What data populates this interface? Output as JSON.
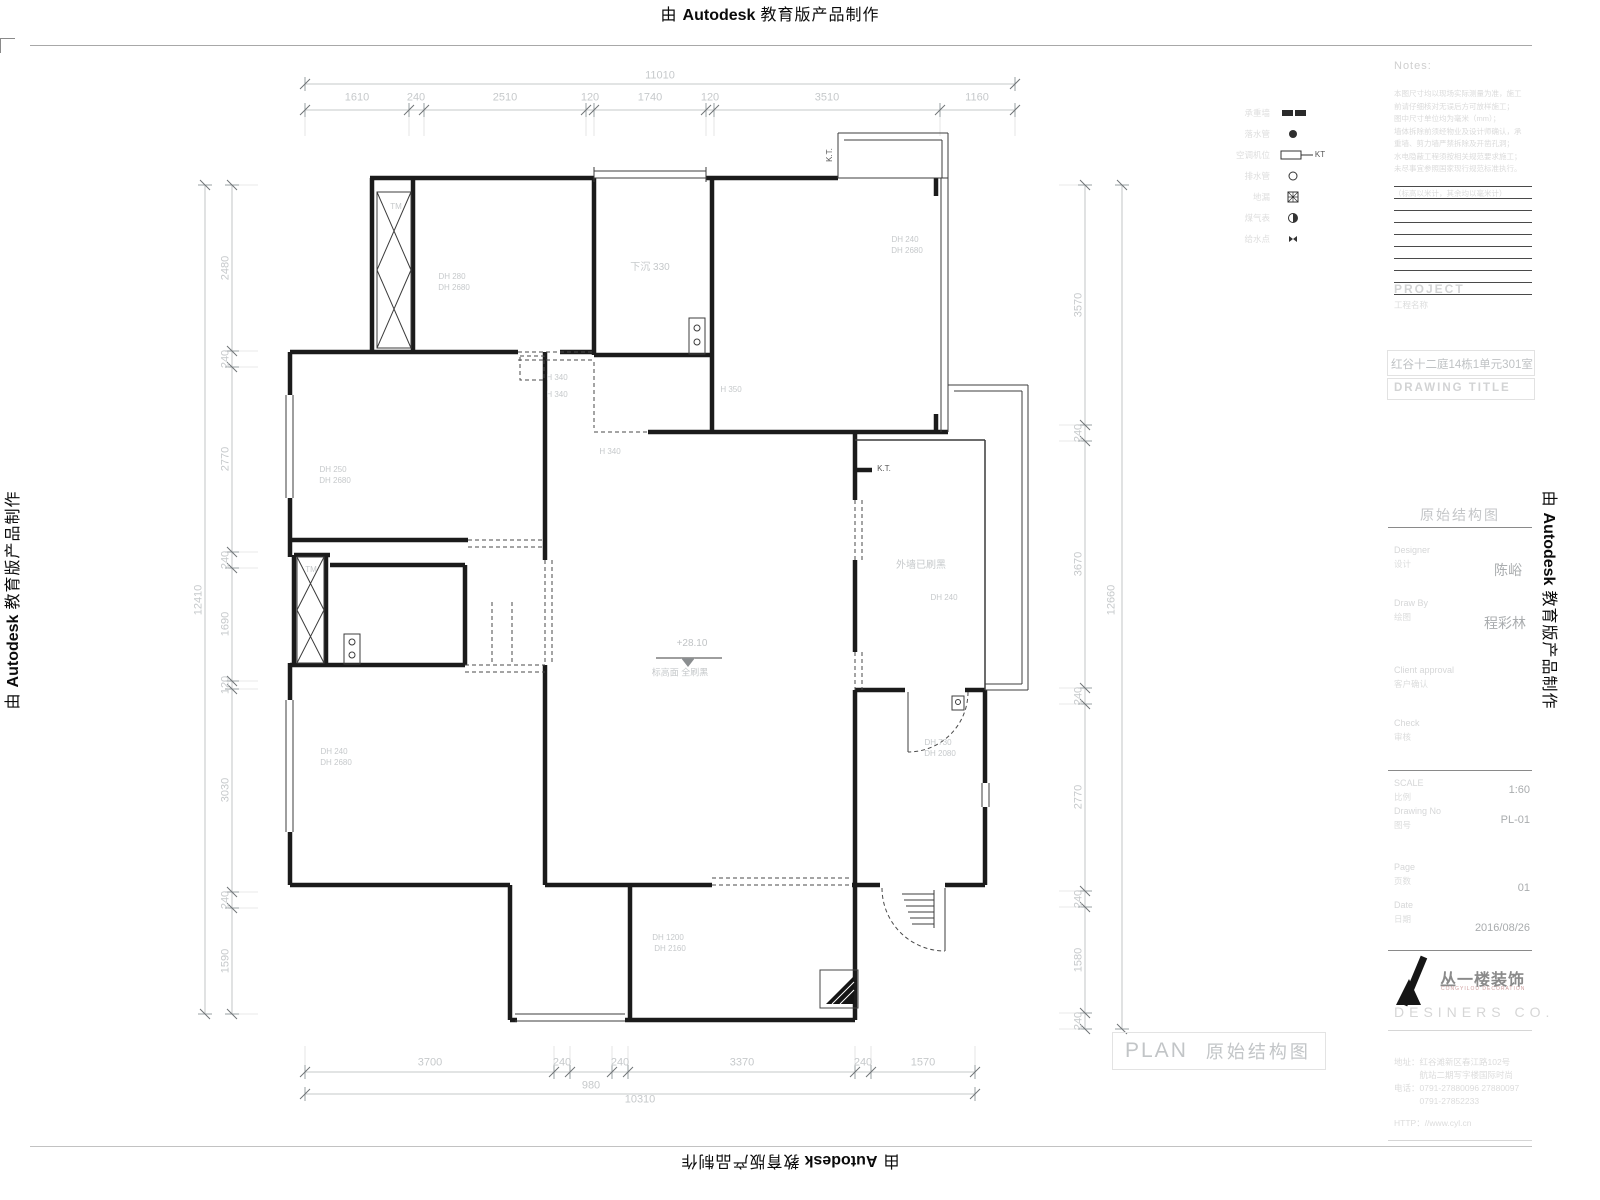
{
  "watermark": {
    "prefix": "由",
    "brand": "Autodesk",
    "suffix": "教育版产品制作"
  },
  "dimensions": {
    "top": [
      {
        "t": "11010",
        "x": 660,
        "y": 76
      },
      {
        "t": "1610",
        "x": 357,
        "y": 98
      },
      {
        "t": "240",
        "x": 416,
        "y": 98
      },
      {
        "t": "2510",
        "x": 505,
        "y": 98
      },
      {
        "t": "120",
        "x": 590,
        "y": 98
      },
      {
        "t": "1740",
        "x": 650,
        "y": 98
      },
      {
        "t": "120",
        "x": 710,
        "y": 98
      },
      {
        "t": "3510",
        "x": 827,
        "y": 98
      },
      {
        "t": "1160",
        "x": 977,
        "y": 98
      }
    ],
    "left": [
      {
        "t": "12410",
        "x": 199,
        "y": 600,
        "r": -90
      },
      {
        "t": "2480",
        "x": 226,
        "y": 268,
        "r": -90
      },
      {
        "t": "240",
        "x": 226,
        "y": 359,
        "r": -90
      },
      {
        "t": "2770",
        "x": 226,
        "y": 459,
        "r": -90
      },
      {
        "t": "240",
        "x": 226,
        "y": 560,
        "r": -90
      },
      {
        "t": "1690",
        "x": 226,
        "y": 624,
        "r": -90
      },
      {
        "t": "120",
        "x": 226,
        "y": 685,
        "r": -90
      },
      {
        "t": "3030",
        "x": 226,
        "y": 790,
        "r": -90
      },
      {
        "t": "240",
        "x": 226,
        "y": 900,
        "r": -90
      },
      {
        "t": "1590",
        "x": 226,
        "y": 961,
        "r": -90
      }
    ],
    "right": [
      {
        "t": "3570",
        "x": 1079,
        "y": 305,
        "r": -90
      },
      {
        "t": "240",
        "x": 1079,
        "y": 433,
        "r": -90
      },
      {
        "t": "3670",
        "x": 1079,
        "y": 564,
        "r": -90
      },
      {
        "t": "12660",
        "x": 1112,
        "y": 600,
        "r": -90
      },
      {
        "t": "240",
        "x": 1079,
        "y": 696,
        "r": -90
      },
      {
        "t": "2770",
        "x": 1079,
        "y": 797,
        "r": -90
      },
      {
        "t": "240",
        "x": 1079,
        "y": 899,
        "r": -90
      },
      {
        "t": "1580",
        "x": 1079,
        "y": 960,
        "r": -90
      },
      {
        "t": "240",
        "x": 1079,
        "y": 1021,
        "r": -90
      }
    ],
    "bottom": [
      {
        "t": "3700",
        "x": 430,
        "y": 1063
      },
      {
        "t": "240",
        "x": 562,
        "y": 1063
      },
      {
        "t": "240",
        "x": 620,
        "y": 1063
      },
      {
        "t": "3370",
        "x": 742,
        "y": 1063
      },
      {
        "t": "240",
        "x": 863,
        "y": 1063
      },
      {
        "t": "1570",
        "x": 923,
        "y": 1063
      },
      {
        "t": "980",
        "x": 591,
        "y": 1086
      },
      {
        "t": "10310",
        "x": 640,
        "y": 1100
      }
    ]
  },
  "annotations": [
    {
      "t": "TM",
      "x": 396,
      "y": 207,
      "s": 8
    },
    {
      "t": "TM",
      "x": 311,
      "y": 570,
      "s": 8
    },
    {
      "t": "下沉 330",
      "x": 650,
      "y": 268,
      "s": 10
    },
    {
      "t": "DH 240",
      "x": 905,
      "y": 240,
      "s": 8
    },
    {
      "t": "DH 2680",
      "x": 907,
      "y": 251,
      "s": 8
    },
    {
      "t": "DH 280",
      "x": 452,
      "y": 277,
      "s": 8
    },
    {
      "t": "DH 2680",
      "x": 454,
      "y": 288,
      "s": 8
    },
    {
      "t": "DH 250",
      "x": 333,
      "y": 470,
      "s": 8
    },
    {
      "t": "DH 2680",
      "x": 335,
      "y": 481,
      "s": 8
    },
    {
      "t": "DH 240",
      "x": 334,
      "y": 752,
      "s": 8
    },
    {
      "t": "DH 2680",
      "x": 336,
      "y": 763,
      "s": 8
    },
    {
      "t": "DH 240",
      "x": 944,
      "y": 598,
      "s": 8
    },
    {
      "t": "DH 730",
      "x": 938,
      "y": 743,
      "s": 8
    },
    {
      "t": "DH 2080",
      "x": 940,
      "y": 754,
      "s": 8
    },
    {
      "t": "DH 1200",
      "x": 668,
      "y": 938,
      "s": 8
    },
    {
      "t": "DH 2160",
      "x": 670,
      "y": 949,
      "s": 8
    },
    {
      "t": "H 340",
      "x": 557,
      "y": 378,
      "s": 8
    },
    {
      "t": "H 340",
      "x": 557,
      "y": 395,
      "s": 8
    },
    {
      "t": "H 350",
      "x": 731,
      "y": 390,
      "s": 8
    },
    {
      "t": "H 340",
      "x": 610,
      "y": 452,
      "s": 8
    },
    {
      "t": "K.T.",
      "x": 830,
      "y": 155,
      "r": -90,
      "s": 8,
      "c": "#555555"
    },
    {
      "t": "K.T.",
      "x": 884,
      "y": 469,
      "s": 8,
      "c": "#555555"
    },
    {
      "t": "外墙已刷黑",
      "x": 921,
      "y": 566,
      "s": 10
    },
    {
      "t": "+28.10",
      "x": 692,
      "y": 644,
      "s": 10,
      "c": "#c0c3c5"
    },
    {
      "t": "标高面 全刷黑",
      "x": 680,
      "y": 673,
      "s": 9
    },
    {
      "t": "KT",
      "x": 1320,
      "y": 155,
      "s": 8,
      "c": "#555555"
    }
  ],
  "legend": {
    "items": [
      {
        "label": "承重墙"
      },
      {
        "label": "落水管"
      },
      {
        "label": "空调机位"
      },
      {
        "label": "排水管"
      },
      {
        "label": "地漏"
      },
      {
        "label": "煤气表"
      },
      {
        "label": "给水点"
      }
    ]
  },
  "notes": {
    "title": "Notes:",
    "lines": [
      "本图尺寸均以现场实际测量为准，施工",
      "前请仔细核对无误后方可放样施工；",
      "图中尺寸单位均为毫米（mm）；",
      "墙体拆除前须经物业及设计师确认，承",
      "重墙、剪力墙严禁拆除及开凿孔洞；",
      "水电隐蔽工程须按相关规范要求施工；",
      "未尽事宜参照国家现行规范标准执行。",
      "",
      "（标高以米计，其余均以毫米计）"
    ]
  },
  "title_block": {
    "project_label": "PROJECT",
    "project_label_cn": "工程名称",
    "project_name": "红谷十二庭14栋1单元301室",
    "drawing_title_label": "DRAWING TITLE",
    "drawing_name": "原始结构图",
    "designer_label": "Designer",
    "designer_label_cn": "设计",
    "designer": "陈峪",
    "drawby_label": "Draw By",
    "drawby_label_cn": "绘图",
    "drawby": "程彩林",
    "client_label": "Client approval",
    "client_label_cn": "客户确认",
    "check_label": "Check",
    "check_label_cn": "审核",
    "scale_label": "SCALE",
    "scale_label_cn": "比例",
    "scale": "1:60",
    "no_label": "Drawing No",
    "no_label_cn": "图号",
    "drawing_no": "PL-01",
    "page_label": "Page",
    "page_label_cn": "页数",
    "page": "01",
    "date_label": "Date",
    "date_label_cn": "日期",
    "date": "2016/08/26",
    "company": "丛一楼装饰",
    "company_sub": "CONGYILOU DECORATION",
    "designers": "DESINERS CO.",
    "address1": "地址：红谷滩新区春江路102号",
    "address2": "　　　航站二期写字楼国际时尚",
    "address3": "电话：0791-27880096 27880097",
    "address4": "　　　0791-27852233",
    "http": "HTTP：//www.cyl.cn"
  },
  "footer": {
    "plan_label": "PLAN",
    "plan_title": "原始结构图"
  }
}
